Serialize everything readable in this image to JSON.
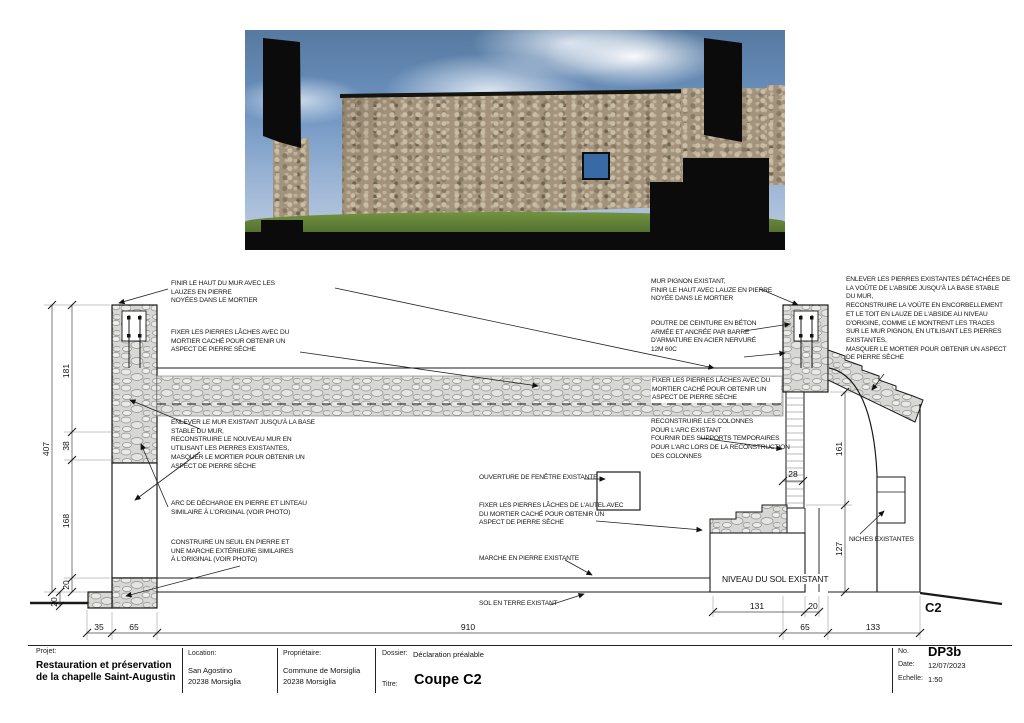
{
  "palette": {
    "sky_blue": "#6c92c0",
    "stone_tan": "#a3937c",
    "grass_green": "#5d7d35",
    "silhouette_black": "#0b0b0b",
    "drawing_stone_gray": "#d7d7d5",
    "line_black": "#1a1a1a"
  },
  "annotations": {
    "finir_haut_mur": "FINIR LE HAUT DU MUR AVEC LES\nLAUZES EN PIERRE\nNOYÉES DANS LE MORTIER",
    "fixer_pierres_gauche": "FIXER LES PIERRES LÂCHES AVEC DU\nMORTIER CACHÉ POUR OBTENIR UN\nASPECT DE PIERRE SÈCHE",
    "enlever_mur": "ENLEVER LE MUR EXISTANT JUSQU'À LA BASE\nSTABLE DU MUR,\nRECONSTRUIRE LE NOUVEAU MUR EN\nUTILISANT LES PIERRES EXISTANTES,\nMASQUER LE MORTIER POUR OBTENIR UN\nASPECT DE PIERRE SÈCHE",
    "arc_decharge": "ARC DE DÉCHARGE EN PIERRE ET LINTEAU\nSIMILAIRE À L'ORIGINAL (VOIR PHOTO)",
    "construire_seuil": "CONSTRUIRE UN SEUIL EN PIERRE ET\nUNE MARCHE EXTÉRIEURE SIMILAIRES\nÀ L'ORIGINAL (VOIR PHOTO)",
    "ouverture_fenetre": "OUVERTURE DE FENÊTRE EXISTANTE",
    "fixer_autel": "FIXER LES PIERRES LÂCHES DE L'AUTEL AVEC\nDU MORTIER CACHÉ POUR OBTENIR UN\nASPECT DE PIERRE SÈCHE",
    "marche_existante": "MARCHE EN PIERRE EXISTANTE",
    "sol_terre": "SOL EN TERRE EXISTANT",
    "mur_pignon": "MUR PIGNON EXISTANT,\nFINIR LE HAUT AVEC LAUZE EN PIERRE\nNOYÉE DANS LE MORTIER",
    "poutre_ceinture": "POUTRE DE CEINTURE EN BÉTON\nARMÉE ET ANCRÉE PAR BARRE\nD'ARMATURE EN ACIER NERVURÉ\n12M 60C",
    "fixer_pierres_droite": "FIXER LES PIERRES LÂCHES AVEC DU\nMORTIER CACHÉ POUR OBTENIR UN\nASPECT DE PIERRE SÈCHE",
    "reconstruire_colonnes": "RECONSTRUIRE LES COLONNES\nPOUR L'ARC EXISTANT\nFOURNIR DES SUPPORTS TEMPORAIRES\nPOUR L'ARC LORS DE LA RECONSTRUCTION\nDES COLONNES",
    "enlever_pierres_voute": "ENLEVER LES PIERRES EXISTANTES DÉTACHÉES DE\nLA VOÛTE DE L'ABSIDE JUSQU'À LA BASE STABLE\nDU MUR,\nRECONSTRUIRE LA VOÛTE EN ENCORBELLEMENT\nET LE TOIT EN LAUZE DE L'ABSIDE AU NIVEAU\nD'ORIGINE, COMME LE MONTRENT LES TRACES\nSUR LE MUR PIGNON, EN UTILISANT LES PIERRES\nEXISTANTES,\nMASQUER LE MORTIER POUR OBTENIR UN ASPECT\nDE PIERRE SÈCHE",
    "niches": "NICHES EXISTANTES",
    "niveau_sol": "NIVEAU DU SOL EXISTANT",
    "section_label": "C2"
  },
  "dims": {
    "h181": "181",
    "h38": "38",
    "h168": "168",
    "h20_floor": "20",
    "h407": "407",
    "h20_ext": "20",
    "w35": "35",
    "w65_left": "65",
    "w910": "910",
    "w131": "131",
    "w20_right": "20",
    "w65_right": "65",
    "w133": "133",
    "h161": "161",
    "h127": "127",
    "w28": "28"
  },
  "titleblock": {
    "projet_label": "Projet:",
    "projet": "Restauration et préservation\nde la chapelle Saint-Augustin",
    "location_label": "Location:",
    "location": "San Agostino\n20238 Morsiglia",
    "proprietaire_label": "Propriétaire:",
    "proprietaire": "Commune de Morsiglia\n20238 Morsiglia",
    "dossier_label": "Dossier:",
    "dossier": "Déclaration préalable",
    "titre_label": "Titre:",
    "titre": "Coupe C2",
    "no_label": "No.",
    "no": "DP3b",
    "date_label": "Date:",
    "date": "12/07/2023",
    "echelle_label": "Echelle:",
    "echelle": "1:50"
  }
}
